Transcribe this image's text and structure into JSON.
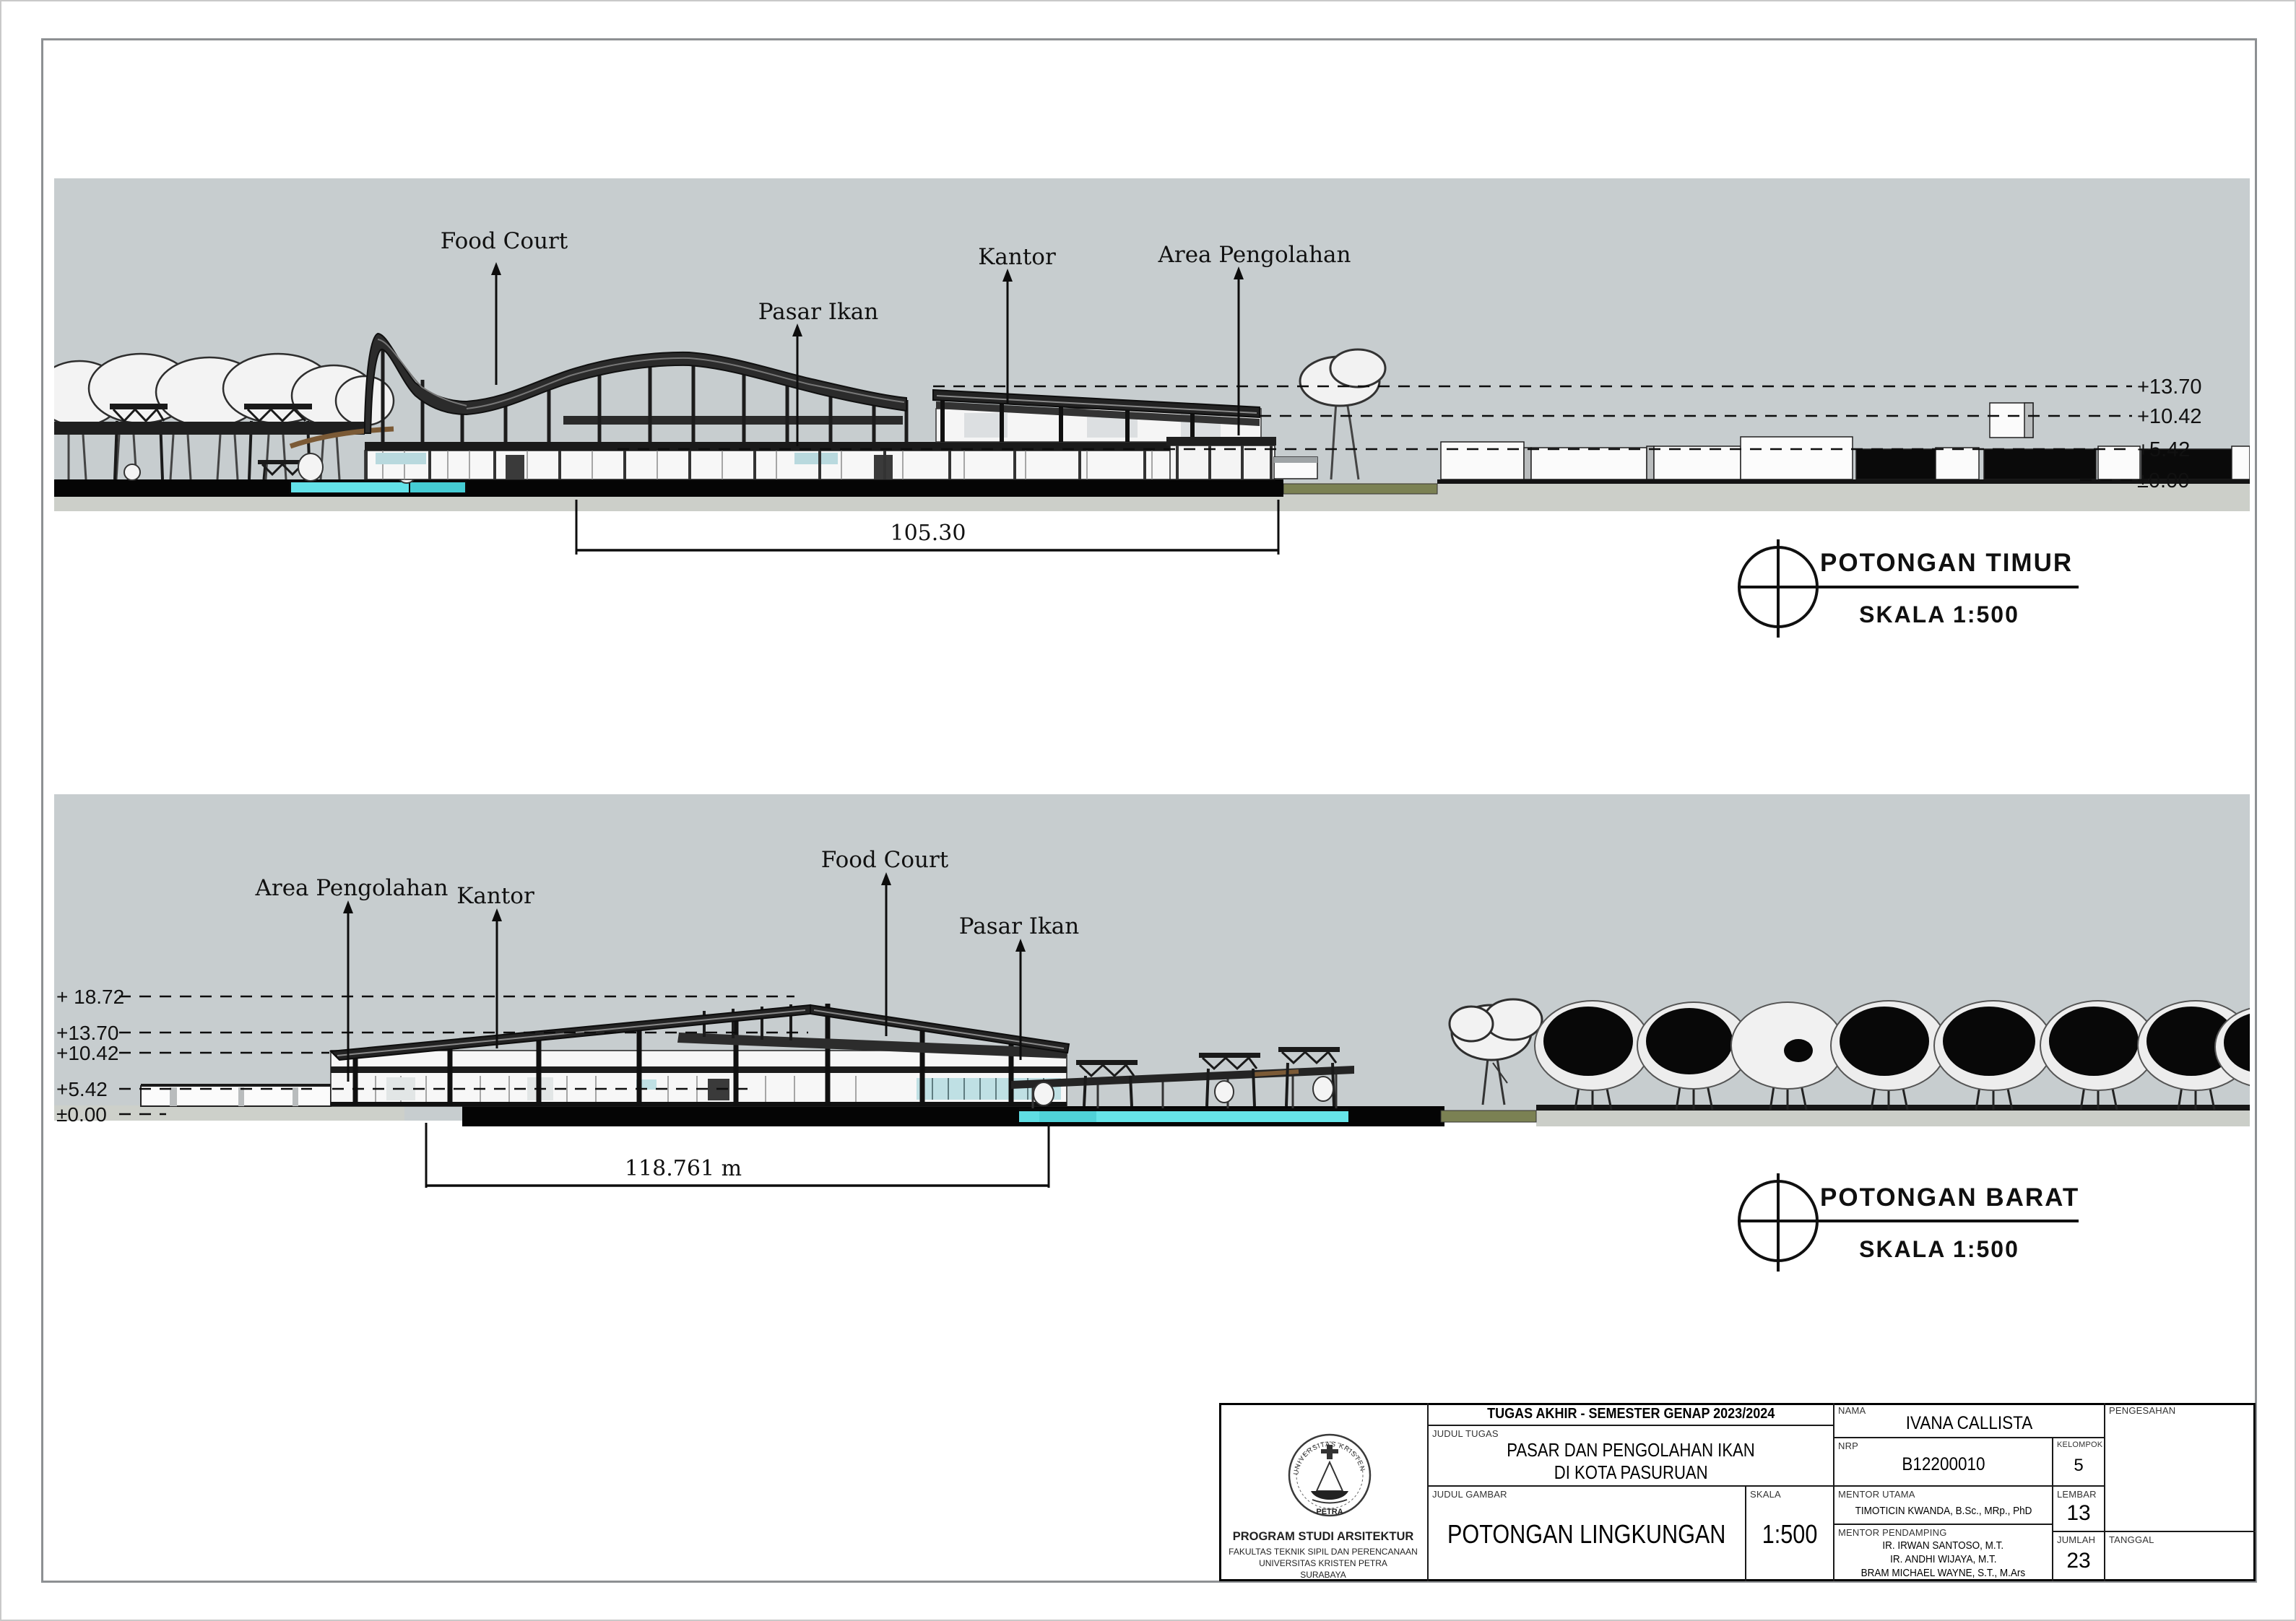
{
  "colors": {
    "panel_grey": "#c7cdcf",
    "ground_grey": "#cccfc9",
    "pool_cyan": "#63e2e8",
    "olive_green": "#7b8153",
    "ink": "#111111"
  },
  "sections": {
    "timur": {
      "title": "POTONGAN TIMUR",
      "scale_label": "SKALA 1:500",
      "dimension": "105.30",
      "labels": [
        {
          "text": "Food Court"
        },
        {
          "text": "Pasar Ikan"
        },
        {
          "text": "Kantor"
        },
        {
          "text": "Area Pengolahan"
        }
      ],
      "levels": [
        {
          "text": "+13.70"
        },
        {
          "text": "+10.42"
        },
        {
          "text": "+5.42"
        },
        {
          "text": "±0.00"
        }
      ]
    },
    "barat": {
      "title": "POTONGAN BARAT",
      "scale_label": "SKALA 1:500",
      "dimension": "118.761 m",
      "labels": [
        {
          "text": "Area Pengolahan"
        },
        {
          "text": "Kantor"
        },
        {
          "text": "Food Court"
        },
        {
          "text": "Pasar Ikan"
        }
      ],
      "levels": [
        {
          "text": "+ 18.72"
        },
        {
          "text": "+13.70"
        },
        {
          "text": "+10.42"
        },
        {
          "text": "+5.42"
        },
        {
          "text": "±0.00"
        }
      ]
    }
  },
  "title_block": {
    "header": "TUGAS AKHIR - SEMESTER GENAP 2023/2024",
    "judul_tugas_label": "JUDUL TUGAS",
    "judul_tugas_line1": "PASAR DAN PENGOLAHAN IKAN",
    "judul_tugas_line2": "DI KOTA PASURUAN",
    "judul_gambar_label": "JUDUL GAMBAR",
    "judul_gambar_value": "POTONGAN LINGKUNGAN",
    "skala_label": "SKALA",
    "skala_value": "1:500",
    "nama_label": "NAMA",
    "nama_value": "IVANA CALLISTA",
    "nrp_label": "NRP",
    "nrp_value": "B12200010",
    "kelompok_label": "KELOMPOK",
    "kelompok_value": "5",
    "mentor_utama_label": "MENTOR UTAMA",
    "mentor_utama_value": "TIMOTICIN KWANDA, B.Sc., MRp., PhD",
    "mentor_pendamping_label": "MENTOR PENDAMPING",
    "mentor_pendamping": [
      "IR. IRWAN SANTOSO, M.T.",
      "IR. ANDHI WIJAYA, M.T.",
      "BRAM MICHAEL WAYNE, S.T., M.Ars"
    ],
    "lembar_label": "LEMBAR",
    "lembar_value": "13",
    "jumlah_label": "JUMLAH",
    "jumlah_value": "23",
    "pengesahan_label": "PENGESAHAN",
    "tanggal_label": "TANGGAL",
    "logo": {
      "arc_text": "UNIVERSITAS KRISTEN",
      "banner_text": "PETRA"
    },
    "institution": {
      "line1": "PROGRAM STUDI ARSITEKTUR",
      "line2": "FAKULTAS TEKNIK SIPIL DAN PERENCANAAN",
      "line3": "UNIVERSITAS KRISTEN PETRA",
      "line4": "SURABAYA"
    }
  }
}
